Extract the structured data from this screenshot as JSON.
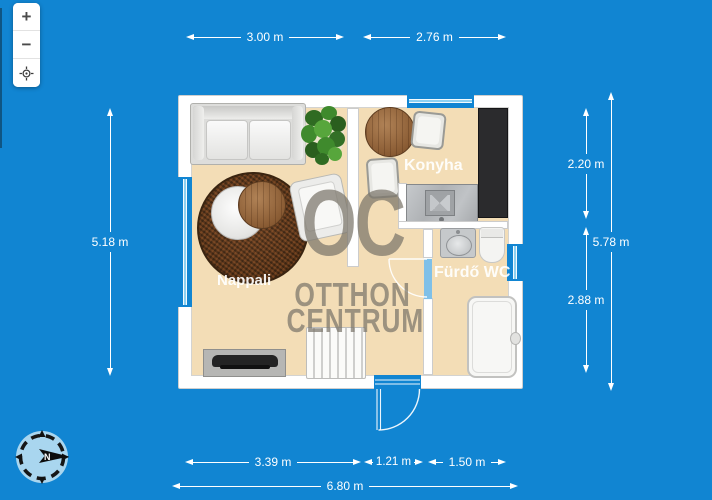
{
  "colors": {
    "background": "#1185d2",
    "floor": "#f3ddb6",
    "wall": "#ffffff",
    "window_glass": "#8ed1f1",
    "door_leaf": "#7fc0e8",
    "watermark_gray": "#7a756a",
    "dimension_text": "#ffffff"
  },
  "toolbar": {
    "zoom_in": "+",
    "zoom_out": "−",
    "locate_icon": "crosshair-locate-icon"
  },
  "compass": {
    "north": "N"
  },
  "plan": {
    "rooms": {
      "living": "Nappali",
      "kitchen": "Konyha",
      "bathroom": "Fürdő WC"
    },
    "watermark": {
      "logo": "OC",
      "line1": "OTTHON",
      "line2": "CENTRUM"
    }
  },
  "dimensions": {
    "top": [
      "3.00 m",
      "2.76 m"
    ],
    "left": [
      "5.18 m"
    ],
    "right_inner": [
      "2.20 m",
      "2.88 m"
    ],
    "right_outer": "5.78 m",
    "bottom": [
      "3.39 m",
      "1.21 m",
      "1.50 m"
    ],
    "bottom_total": "6.80 m"
  }
}
